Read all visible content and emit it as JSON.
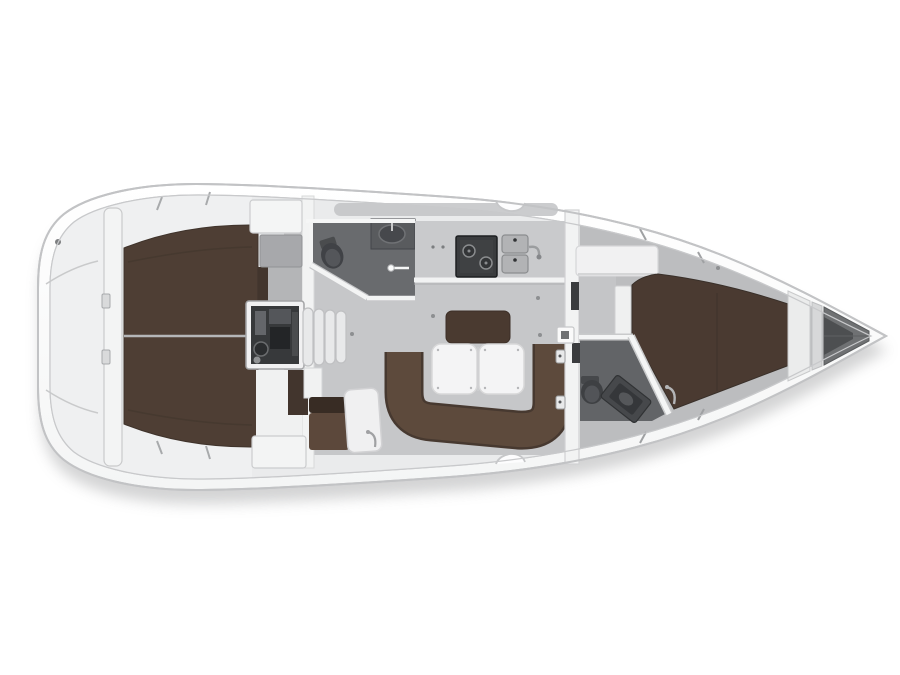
{
  "image": {
    "type": "interior-layout-plan",
    "subject": "Sailing yacht floor plan, top-down view, bow pointing right",
    "text_content": "none (image contains no visible text)"
  },
  "palette": {
    "hull_stroke": "#c2c3c5",
    "deck_fill": "#e9eaeb",
    "deck_stroke": "#c8c9cb",
    "aft_zone_fill": "#eff0f1",
    "saloon_deck_fill": "#eaebec",
    "sidedeck_fill": "#bcbdbf",
    "saloon_floor": "#c6c7c9",
    "head_floor": "#696b6e",
    "head_floor_fwd": "#626467",
    "berth_aft": "#4e3e34",
    "berth_fore": "#4a3a31",
    "cabinet_dark": "#42352d",
    "settee_fill": "#5d4a3c",
    "settee_dark": "#473930",
    "backrest_fill": "#4a3a30",
    "table_fill": "#f4f4f5",
    "white_unit": "#f1f1f2",
    "unit_stroke": "#cdced0",
    "appliance_fill": "#3a3c3e",
    "engine_inner": "#37393b",
    "anchor_locker": "#6f7173",
    "shadow_color": "#97989a"
  },
  "rooms": [
    {
      "id": "stern_locker",
      "label": "Stern locker / lazarette"
    },
    {
      "id": "aft_cabin_port",
      "label": "Aft double cabin (port)"
    },
    {
      "id": "aft_cabin_stbd",
      "label": "Aft double cabin (starboard)"
    },
    {
      "id": "engine",
      "label": "Engine compartment under companionway"
    },
    {
      "id": "companionway",
      "label": "Companionway steps"
    },
    {
      "id": "aft_head",
      "label": "Aft head with WC and washbasin"
    },
    {
      "id": "galley",
      "label": "Galley with stove and twin sinks"
    },
    {
      "id": "saloon",
      "label": "Saloon with U-shaped settee and folding table"
    },
    {
      "id": "nav_station",
      "label": "Navigation station with chart table"
    },
    {
      "id": "fwd_head",
      "label": "Forward head with WC and washbasin"
    },
    {
      "id": "fwd_cabin",
      "label": "Forward owner's cabin with V-berth"
    },
    {
      "id": "anchor_locker",
      "label": "Anchor locker in the bow"
    }
  ],
  "furniture": [
    {
      "id": "aft_berths",
      "label": "Aft berth cushions"
    },
    {
      "id": "v_berth",
      "label": "V-berth cushion"
    },
    {
      "id": "settee",
      "label": "U-shaped settee"
    },
    {
      "id": "table",
      "label": "Folding saloon table, two leaves"
    },
    {
      "id": "stove",
      "label": "Two-burner gimballed stove"
    },
    {
      "id": "galley_sinks",
      "label": "Twin galley sinks with faucet"
    },
    {
      "id": "toilet",
      "label": "Marine toilet"
    },
    {
      "id": "washbasin",
      "label": "Washbasin"
    },
    {
      "id": "steps",
      "label": "Companionway steps"
    },
    {
      "id": "chart_table",
      "label": "Chart table with seat"
    }
  ]
}
